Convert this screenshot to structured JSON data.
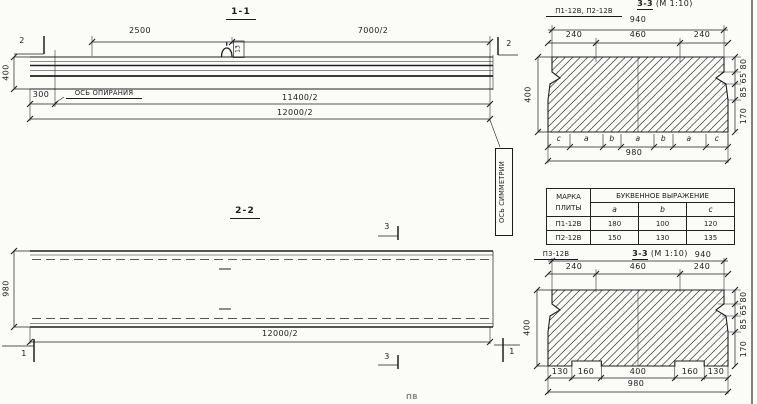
{
  "drawing": {
    "ink": "#1f1f1f",
    "bg": "#fbfbf8"
  },
  "section_1_1": {
    "title": "1-1",
    "marker_left": "2",
    "marker_right": "2",
    "dim_2500": "2500",
    "dim_7000_2": "7000/2",
    "dim_400": "400",
    "dim_300": "300",
    "dim_11400_2": "11400/2",
    "dim_12000_2": "12000/2",
    "support_axis_label": "ОСЬ ОПИРАНИЯ",
    "loop_mark": "13"
  },
  "symmetry_axis_label": "ОСЬ СИММЕТРИИ",
  "section_2_2": {
    "title": "2-2",
    "marker_3_top": "3",
    "marker_3_bottom": "3",
    "marker_1_left": "1",
    "marker_1_right": "1",
    "dim_980": "980",
    "dim_12000_2": "12000/2"
  },
  "section_3_3_top": {
    "plates_label": "П1-12В, П2-12В",
    "title": "3-3",
    "scale": "(М 1:10)",
    "dim_940": "940",
    "segs": [
      "240",
      "460",
      "240"
    ],
    "dim_400": "400",
    "right_stack": [
      "80",
      "65",
      "85",
      "170"
    ],
    "letters": [
      "с",
      "а",
      "b",
      "а",
      "b",
      "а",
      "с"
    ],
    "dim_980": "980"
  },
  "table": {
    "col_mark_header": "МАРКА ПЛИТЫ",
    "group_header": "БУКВЕННОЕ ВЫРАЖЕНИЕ",
    "sub_headers": [
      "а",
      "b",
      "с"
    ],
    "rows": [
      {
        "mark": "П1-12В",
        "a": "180",
        "b": "100",
        "c": "120"
      },
      {
        "mark": "П2-12В",
        "a": "150",
        "b": "130",
        "c": "135"
      }
    ]
  },
  "section_3_3_bottom": {
    "plate_label": "П3-12В",
    "title": "3-3",
    "scale": "(М 1:10)",
    "dim_940": "940",
    "segs": [
      "240",
      "460",
      "240"
    ],
    "dim_400": "400",
    "right_stack": [
      "80",
      "65",
      "85",
      "170"
    ],
    "bottom_segs": [
      "130",
      "160",
      "400",
      "160",
      "130"
    ],
    "dim_980": "980"
  },
  "edge_fragment": "ПВ"
}
